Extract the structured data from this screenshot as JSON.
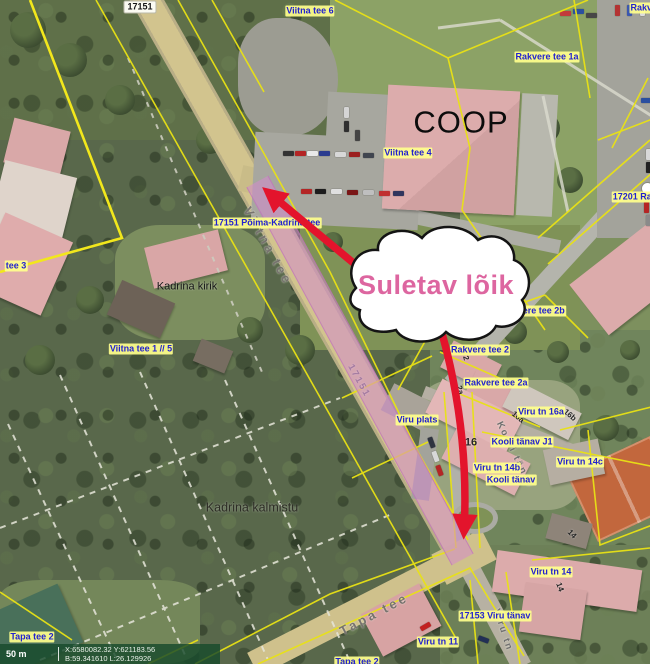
{
  "map": {
    "callout": {
      "text": "Suletav lõik"
    },
    "labels": [
      {
        "t": "Viitna tee",
        "cls": "road lg",
        "x": 268,
        "y": 246,
        "r": 61
      },
      {
        "t": "17151",
        "cls": "road",
        "x": 359,
        "y": 381,
        "r": 61
      },
      {
        "t": "Kooli tänav",
        "cls": "road",
        "x": 515,
        "y": 455,
        "r": 64
      },
      {
        "t": "Tapa tee",
        "cls": "road lg",
        "x": 374,
        "y": 614,
        "r": -28
      },
      {
        "t": "Viru tn",
        "cls": "road",
        "x": 503,
        "y": 630,
        "r": 72
      },
      {
        "t": "2",
        "cls": "hn",
        "x": 466,
        "y": 358,
        "r": 75
      },
      {
        "t": "2a",
        "cls": "hn",
        "x": 460,
        "y": 390,
        "r": 75
      },
      {
        "t": "16a",
        "cls": "hn",
        "x": 518,
        "y": 417,
        "r": 40
      },
      {
        "t": "16b",
        "cls": "hn",
        "x": 570,
        "y": 415,
        "r": 40
      },
      {
        "t": "16",
        "cls": "hn lg",
        "x": 471,
        "y": 443,
        "r": 0
      },
      {
        "t": "14",
        "cls": "hn",
        "x": 572,
        "y": 534,
        "r": 45
      },
      {
        "t": "14",
        "cls": "hn",
        "x": 560,
        "y": 587,
        "r": 70
      },
      {
        "t": "COOP",
        "cls": "coop",
        "x": 461,
        "y": 122,
        "r": 0
      },
      {
        "t": "Kadrina kirik",
        "cls": "place",
        "x": 187,
        "y": 287,
        "r": 0
      },
      {
        "t": "Kadrina kalmistu",
        "cls": "place lg",
        "x": 252,
        "y": 508,
        "r": 0
      },
      {
        "t": "17151",
        "cls": "shield",
        "x": 140,
        "y": 7,
        "r": 0
      },
      {
        "t": "Viitna tee 6",
        "cls": "blue",
        "x": 310,
        "y": 11,
        "r": 0
      },
      {
        "t": "Rakvere",
        "cls": "blue",
        "x": 648,
        "y": 8,
        "r": 0
      },
      {
        "t": "Rakvere tee 1a",
        "cls": "blue",
        "x": 547,
        "y": 57,
        "r": 0
      },
      {
        "t": "Viitna tee 4",
        "cls": "blue",
        "x": 408,
        "y": 153,
        "r": 0
      },
      {
        "t": "17201 Rakvere",
        "cls": "blue",
        "x": 644,
        "y": 197,
        "r": 0
      },
      {
        "t": "17151 Põima-Kadrina tee",
        "cls": "blue",
        "x": 267,
        "y": 223,
        "r": 0
      },
      {
        "t": "tee 3",
        "cls": "blue",
        "x": 16,
        "y": 266,
        "r": 0
      },
      {
        "t": "Viitna tee 1 // 5",
        "cls": "blue",
        "x": 141,
        "y": 349,
        "r": 0
      },
      {
        "t": "Rakvere tee 2b",
        "cls": "blue",
        "x": 533,
        "y": 311,
        "r": 0
      },
      {
        "t": "Rakvere tee 2",
        "cls": "blue",
        "x": 480,
        "y": 350,
        "r": 0
      },
      {
        "t": "Rakvere tee 2a",
        "cls": "blue",
        "x": 496,
        "y": 383,
        "r": 0
      },
      {
        "t": "Viru tn 16a",
        "cls": "blue",
        "x": 541,
        "y": 412,
        "r": 0
      },
      {
        "t": "Viru plats",
        "cls": "blue",
        "x": 417,
        "y": 420,
        "r": 0
      },
      {
        "t": "Kooli tänav J1",
        "cls": "blue",
        "x": 522,
        "y": 442,
        "r": 0
      },
      {
        "t": "Viru tn 14c",
        "cls": "blue",
        "x": 580,
        "y": 462,
        "r": 0
      },
      {
        "t": "Viru tn 14b",
        "cls": "blue",
        "x": 497,
        "y": 468,
        "r": 0
      },
      {
        "t": "Kooli tänav",
        "cls": "blue",
        "x": 511,
        "y": 480,
        "r": 0
      },
      {
        "t": "Viru tn 14",
        "cls": "blue",
        "x": 551,
        "y": 572,
        "r": 0
      },
      {
        "t": "17153 Viru tänav",
        "cls": "blue",
        "x": 495,
        "y": 616,
        "r": 0
      },
      {
        "t": "Viru tn 11",
        "cls": "blue",
        "x": 438,
        "y": 642,
        "r": 0
      },
      {
        "t": "Tapa tee 2",
        "cls": "blue",
        "x": 32,
        "y": 637,
        "r": 0
      },
      {
        "t": "Tapa tee 2",
        "cls": "blue",
        "x": 357,
        "y": 662,
        "r": 0
      }
    ],
    "colors": {
      "closure_highlight": "#d488d0",
      "arrow_red": "#e3142c",
      "callout_pink": "#dd66a0",
      "cadastral_yellow": "#e9e215",
      "label_blue": "#2222cf",
      "label_halo": "#ffff8c"
    }
  },
  "statusbar": {
    "scale_label": "50 m",
    "coords_line1": "X:6580082.32 Y:621183.56",
    "coords_line2": "B:59.341610 L:26.129926"
  }
}
